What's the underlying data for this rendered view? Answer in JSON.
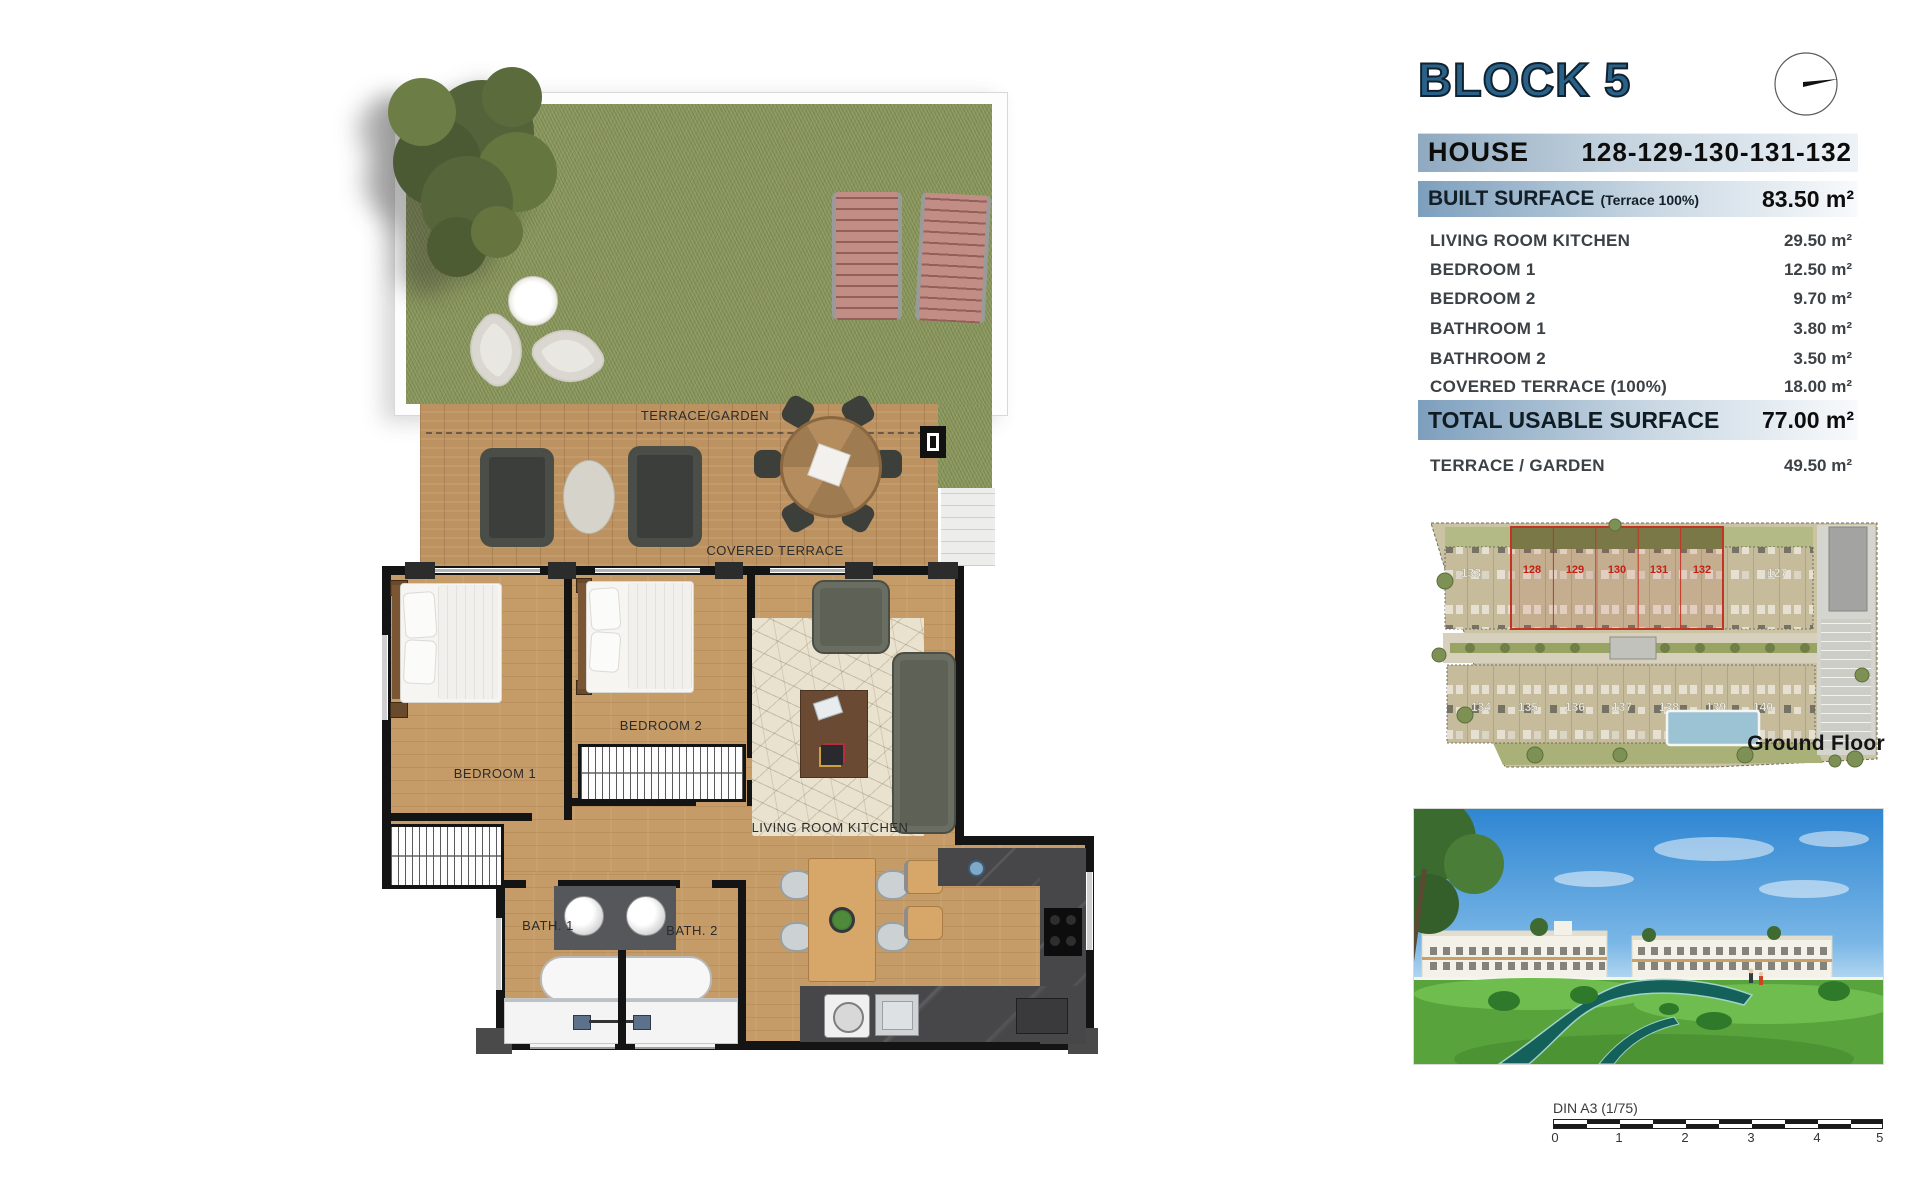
{
  "header": {
    "title": "BLOCK 5",
    "house_label": "HOUSE",
    "house_numbers": "128-129-130-131-132"
  },
  "surface_table": {
    "built": {
      "label": "BUILT SURFACE",
      "note": "(Terrace 100%)",
      "value": "83.50 m²"
    },
    "rows": [
      {
        "label": "LIVING ROOM KITCHEN",
        "value": "29.50 m²"
      },
      {
        "label": "BEDROOM 1",
        "value": "12.50 m²"
      },
      {
        "label": "BEDROOM 2",
        "value": "9.70 m²"
      },
      {
        "label": "BATHROOM 1",
        "value": "3.80 m²"
      },
      {
        "label": "BATHROOM 2",
        "value": "3.50 m²"
      },
      {
        "label": "COVERED TERRACE (100%)",
        "value": "18.00 m²"
      }
    ],
    "total": {
      "label": "TOTAL USABLE SURFACE",
      "value": "77.00 m²"
    },
    "terrace": {
      "label": "TERRACE / GARDEN",
      "value": "49.50 m²"
    }
  },
  "floor_plan": {
    "terrace_garden": "TERRACE/GARDEN",
    "covered_terrace": "COVERED TERRACE",
    "bedroom1": "BEDROOM 1",
    "bedroom2": "BEDROOM 2",
    "living_room_kitchen": "LIVING ROOM KITCHEN",
    "bath1": "BATH. 1",
    "bath2": "BATH. 2"
  },
  "site_plan": {
    "caption": "Ground Floor",
    "unit_left": "133",
    "unit_right": "127",
    "highlighted_units": [
      "128",
      "129",
      "130",
      "131",
      "132"
    ],
    "bottom_units": [
      "134",
      "135",
      "136",
      "137",
      "138",
      "139",
      "140"
    ]
  },
  "scale_bar": {
    "label": "DIN A3 (1/75)",
    "ticks": [
      "0",
      "1",
      "2",
      "3",
      "4",
      "5"
    ]
  },
  "colors": {
    "title_blue": "#2a6189",
    "bar_blue": "#7d9fbd",
    "highlight_red": "#c43425",
    "grass_green": "#8b985e",
    "deck_wood": "#bd9261",
    "floor_wood": "#c59c68",
    "wall_black": "#141414",
    "water_teal": "#14605a",
    "sky_blue": "#3f93d8"
  }
}
